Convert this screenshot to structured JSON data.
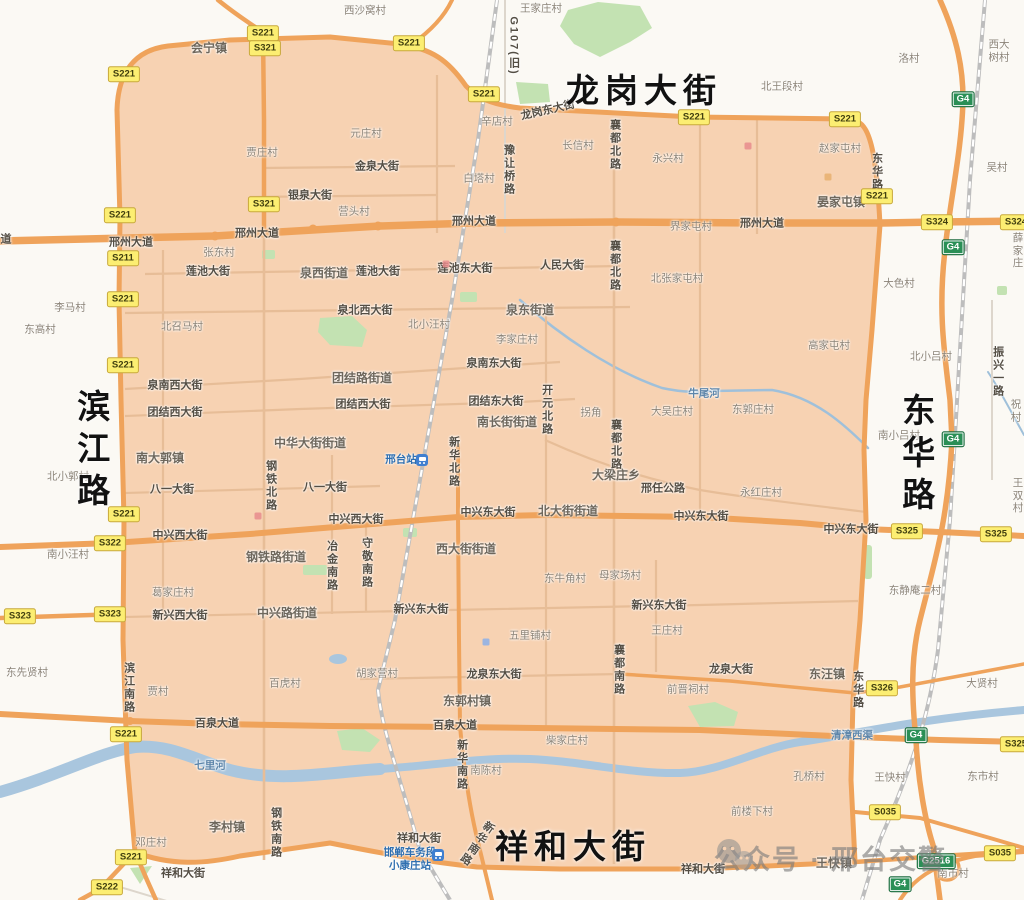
{
  "canvas": {
    "width": 1024,
    "height": 900
  },
  "colors": {
    "zone_fill": "#f7d2b2",
    "road_major": "#efa35b",
    "road_minor_zone": "#e7bd97",
    "road_minor_out": "#ddd6cc",
    "green": "#c3e2b2",
    "water": "#a9c6de",
    "railway": "#bdbdbd",
    "badge_s_bg": "#fcee72",
    "badge_g_bg": "#2a8f56",
    "big_label": "#121212",
    "station_blue": "#2f6fb0"
  },
  "big_labels": [
    {
      "t": "龙岗大街",
      "x": 644,
      "y": 91,
      "c": "bh"
    },
    {
      "t": "滨江路",
      "x": 91,
      "y": 452,
      "c": "bv"
    },
    {
      "t": "东华路",
      "x": 916,
      "y": 456,
      "c": "bv"
    },
    {
      "t": "祥和大街",
      "x": 573,
      "y": 847,
      "c": "bh"
    }
  ],
  "watermark": {
    "text": "公众号 · 邢台交警"
  },
  "labels": [
    {
      "t": "西沙窝村",
      "x": 365,
      "y": 11,
      "c": "v"
    },
    {
      "t": "王家庄村",
      "x": 541,
      "y": 9,
      "c": "v"
    },
    {
      "t": "北王段村",
      "x": 782,
      "y": 87,
      "c": "v"
    },
    {
      "t": "洛村",
      "x": 909,
      "y": 59,
      "c": "v"
    },
    {
      "t": "西大树村",
      "x": 999,
      "y": 51,
      "c": "v"
    },
    {
      "t": "吴村",
      "x": 997,
      "y": 168,
      "c": "v"
    },
    {
      "t": "辛店村",
      "x": 497,
      "y": 122,
      "c": "v"
    },
    {
      "t": "元庄村",
      "x": 366,
      "y": 134,
      "c": "v"
    },
    {
      "t": "贾庄村",
      "x": 262,
      "y": 153,
      "c": "v"
    },
    {
      "t": "白塔村",
      "x": 479,
      "y": 179,
      "c": "v"
    },
    {
      "t": "营头村",
      "x": 354,
      "y": 212,
      "c": "v"
    },
    {
      "t": "张东村",
      "x": 219,
      "y": 253,
      "c": "v"
    },
    {
      "t": "长信村",
      "x": 578,
      "y": 146,
      "c": "v"
    },
    {
      "t": "永兴村",
      "x": 668,
      "y": 159,
      "c": "v"
    },
    {
      "t": "赵家屯村",
      "x": 840,
      "y": 149,
      "c": "v"
    },
    {
      "t": "界家屯村",
      "x": 691,
      "y": 227,
      "c": "v"
    },
    {
      "t": "北张家屯村",
      "x": 677,
      "y": 279,
      "c": "v"
    },
    {
      "t": "大色村",
      "x": 899,
      "y": 284,
      "c": "v"
    },
    {
      "t": "薛家庄",
      "x": 1018,
      "y": 251,
      "c": "v"
    },
    {
      "t": "李马村",
      "x": 70,
      "y": 308,
      "c": "v"
    },
    {
      "t": "东高村",
      "x": 40,
      "y": 330,
      "c": "v"
    },
    {
      "t": "北召马村",
      "x": 182,
      "y": 327,
      "c": "v"
    },
    {
      "t": "北小汪村",
      "x": 429,
      "y": 325,
      "c": "v"
    },
    {
      "t": "李家庄村",
      "x": 517,
      "y": 340,
      "c": "v"
    },
    {
      "t": "高家屯村",
      "x": 829,
      "y": 346,
      "c": "v"
    },
    {
      "t": "北小吕村",
      "x": 931,
      "y": 357,
      "c": "v"
    },
    {
      "t": "南小吕村",
      "x": 899,
      "y": 436,
      "c": "v"
    },
    {
      "t": "祝村",
      "x": 1016,
      "y": 411,
      "c": "v"
    },
    {
      "t": "东郭庄村",
      "x": 753,
      "y": 410,
      "c": "v"
    },
    {
      "t": "大吴庄村",
      "x": 672,
      "y": 412,
      "c": "v"
    },
    {
      "t": "拐角",
      "x": 591,
      "y": 413,
      "c": "v"
    },
    {
      "t": "王双村",
      "x": 1018,
      "y": 496,
      "c": "v"
    },
    {
      "t": "永红庄村",
      "x": 761,
      "y": 493,
      "c": "v"
    },
    {
      "t": "北小郭村",
      "x": 68,
      "y": 477,
      "c": "v"
    },
    {
      "t": "南小汪村",
      "x": 68,
      "y": 555,
      "c": "v"
    },
    {
      "t": "东牛角村",
      "x": 565,
      "y": 579,
      "c": "v"
    },
    {
      "t": "母家场村",
      "x": 620,
      "y": 576,
      "c": "v"
    },
    {
      "t": "葛家庄村",
      "x": 173,
      "y": 593,
      "c": "v"
    },
    {
      "t": "东静庵二村",
      "x": 915,
      "y": 591,
      "c": "v"
    },
    {
      "t": "王庄村",
      "x": 667,
      "y": 631,
      "c": "v"
    },
    {
      "t": "五里铺村",
      "x": 530,
      "y": 636,
      "c": "v"
    },
    {
      "t": "东先贤村",
      "x": 27,
      "y": 673,
      "c": "v"
    },
    {
      "t": "贾村",
      "x": 158,
      "y": 692,
      "c": "v"
    },
    {
      "t": "百虎村",
      "x": 285,
      "y": 684,
      "c": "v"
    },
    {
      "t": "胡家营村",
      "x": 377,
      "y": 674,
      "c": "v"
    },
    {
      "t": "前晋祠村",
      "x": 688,
      "y": 690,
      "c": "v"
    },
    {
      "t": "大贤村",
      "x": 982,
      "y": 684,
      "c": "v"
    },
    {
      "t": "柴家庄村",
      "x": 567,
      "y": 741,
      "c": "v"
    },
    {
      "t": "南陈村",
      "x": 486,
      "y": 771,
      "c": "v"
    },
    {
      "t": "孔桥村",
      "x": 809,
      "y": 777,
      "c": "v"
    },
    {
      "t": "王快村",
      "x": 890,
      "y": 778,
      "c": "v"
    },
    {
      "t": "东市村",
      "x": 983,
      "y": 777,
      "c": "v"
    },
    {
      "t": "前楼下村",
      "x": 752,
      "y": 812,
      "c": "v"
    },
    {
      "t": "邓庄村",
      "x": 151,
      "y": 843,
      "c": "v"
    },
    {
      "t": "南市村",
      "x": 953,
      "y": 874,
      "c": "v"
    },
    {
      "t": "会宁镇",
      "x": 209,
      "y": 48,
      "c": "t"
    },
    {
      "t": "晏家屯镇",
      "x": 841,
      "y": 202,
      "c": "t"
    },
    {
      "t": "泉西街道",
      "x": 324,
      "y": 273,
      "c": "t"
    },
    {
      "t": "泉东街道",
      "x": 530,
      "y": 310,
      "c": "t"
    },
    {
      "t": "团结路街道",
      "x": 362,
      "y": 378,
      "c": "t"
    },
    {
      "t": "中华大街街道",
      "x": 310,
      "y": 443,
      "c": "t"
    },
    {
      "t": "南大郭镇",
      "x": 160,
      "y": 458,
      "c": "t"
    },
    {
      "t": "南长街街道",
      "x": 507,
      "y": 422,
      "c": "t"
    },
    {
      "t": "北大街街道",
      "x": 568,
      "y": 511,
      "c": "t"
    },
    {
      "t": "西大街街道",
      "x": 466,
      "y": 549,
      "c": "t"
    },
    {
      "t": "钢铁路街道",
      "x": 276,
      "y": 557,
      "c": "t"
    },
    {
      "t": "中兴路街道",
      "x": 287,
      "y": 613,
      "c": "t"
    },
    {
      "t": "大梁庄乡",
      "x": 616,
      "y": 475,
      "c": "t"
    },
    {
      "t": "东郭村镇",
      "x": 467,
      "y": 701,
      "c": "t"
    },
    {
      "t": "李村镇",
      "x": 227,
      "y": 827,
      "c": "t"
    },
    {
      "t": "东汪镇",
      "x": 827,
      "y": 674,
      "c": "t"
    },
    {
      "t": "王快镇",
      "x": 834,
      "y": 863,
      "c": "t"
    },
    {
      "t": "龙岗东大街",
      "x": 548,
      "y": 111,
      "c": "s",
      "r": -13
    },
    {
      "t": "金泉大街",
      "x": 377,
      "y": 167,
      "c": "s"
    },
    {
      "t": "银泉大街",
      "x": 310,
      "y": 196,
      "c": "s"
    },
    {
      "t": "邢州大道",
      "x": 131,
      "y": 243,
      "c": "s"
    },
    {
      "t": "邢州大道",
      "x": 257,
      "y": 234,
      "c": "s"
    },
    {
      "t": "邢州大道",
      "x": 474,
      "y": 222,
      "c": "s"
    },
    {
      "t": "邢州大道",
      "x": 762,
      "y": 224,
      "c": "s"
    },
    {
      "t": "莲池大街",
      "x": 208,
      "y": 272,
      "c": "s"
    },
    {
      "t": "莲池大街",
      "x": 378,
      "y": 272,
      "c": "s"
    },
    {
      "t": "莲池东大街",
      "x": 465,
      "y": 269,
      "c": "s"
    },
    {
      "t": "人民大街",
      "x": 562,
      "y": 266,
      "c": "s"
    },
    {
      "t": "泉北西大街",
      "x": 365,
      "y": 311,
      "c": "s"
    },
    {
      "t": "泉南西大街",
      "x": 175,
      "y": 386,
      "c": "s"
    },
    {
      "t": "泉南东大街",
      "x": 494,
      "y": 364,
      "c": "s"
    },
    {
      "t": "团结西大街",
      "x": 175,
      "y": 413,
      "c": "s"
    },
    {
      "t": "团结西大街",
      "x": 363,
      "y": 405,
      "c": "s"
    },
    {
      "t": "团结东大街",
      "x": 496,
      "y": 402,
      "c": "s"
    },
    {
      "t": "八一大街",
      "x": 172,
      "y": 490,
      "c": "s"
    },
    {
      "t": "八一大街",
      "x": 325,
      "y": 488,
      "c": "s"
    },
    {
      "t": "中兴西大街",
      "x": 180,
      "y": 536,
      "c": "s"
    },
    {
      "t": "中兴西大街",
      "x": 356,
      "y": 520,
      "c": "s"
    },
    {
      "t": "中兴东大街",
      "x": 488,
      "y": 513,
      "c": "s"
    },
    {
      "t": "中兴东大街",
      "x": 701,
      "y": 517,
      "c": "s"
    },
    {
      "t": "中兴东大街",
      "x": 851,
      "y": 530,
      "c": "s"
    },
    {
      "t": "新兴西大街",
      "x": 180,
      "y": 616,
      "c": "s"
    },
    {
      "t": "新兴东大街",
      "x": 421,
      "y": 610,
      "c": "s"
    },
    {
      "t": "新兴东大街",
      "x": 659,
      "y": 606,
      "c": "s"
    },
    {
      "t": "龙泉东大街",
      "x": 494,
      "y": 675,
      "c": "s"
    },
    {
      "t": "龙泉大街",
      "x": 731,
      "y": 670,
      "c": "s"
    },
    {
      "t": "百泉大道",
      "x": 217,
      "y": 724,
      "c": "s"
    },
    {
      "t": "百泉大道",
      "x": 455,
      "y": 726,
      "c": "s"
    },
    {
      "t": "祥和大街",
      "x": 183,
      "y": 874,
      "c": "s"
    },
    {
      "t": "祥和大街",
      "x": 419,
      "y": 839,
      "c": "s"
    },
    {
      "t": "祥和大街",
      "x": 703,
      "y": 870,
      "c": "s"
    },
    {
      "t": "邢任公路",
      "x": 663,
      "y": 489,
      "c": "s"
    },
    {
      "t": "道",
      "x": 6,
      "y": 240,
      "c": "s"
    },
    {
      "t": "襄都北路",
      "x": 614,
      "y": 145,
      "c": "sv"
    },
    {
      "t": "襄都北路",
      "x": 614,
      "y": 266,
      "c": "sv"
    },
    {
      "t": "襄都北路",
      "x": 615,
      "y": 445,
      "c": "sv"
    },
    {
      "t": "襄都南路",
      "x": 618,
      "y": 670,
      "c": "sv"
    },
    {
      "t": "豫让桥路",
      "x": 508,
      "y": 170,
      "c": "sv"
    },
    {
      "t": "东华路",
      "x": 876,
      "y": 172,
      "c": "sv"
    },
    {
      "t": "东华路",
      "x": 857,
      "y": 690,
      "c": "sv"
    },
    {
      "t": "开元北路",
      "x": 546,
      "y": 410,
      "c": "sv"
    },
    {
      "t": "新华北路",
      "x": 453,
      "y": 462,
      "c": "sv"
    },
    {
      "t": "新华南路",
      "x": 461,
      "y": 765,
      "c": "sv"
    },
    {
      "t": "新华南路",
      "x": 476,
      "y": 843,
      "c": "sv",
      "r": 35
    },
    {
      "t": "冶金南路",
      "x": 331,
      "y": 566,
      "c": "sv"
    },
    {
      "t": "守敬南路",
      "x": 366,
      "y": 563,
      "c": "sv"
    },
    {
      "t": "钢铁北路",
      "x": 270,
      "y": 486,
      "c": "sv"
    },
    {
      "t": "钢铁南路",
      "x": 275,
      "y": 833,
      "c": "sv"
    },
    {
      "t": "滨江南路",
      "x": 128,
      "y": 688,
      "c": "sv"
    },
    {
      "t": "振兴一路",
      "x": 997,
      "y": 372,
      "c": "sv"
    },
    {
      "t": "G107(旧)",
      "x": 513,
      "y": 46,
      "c": "sv"
    },
    {
      "t": "七里河",
      "x": 210,
      "y": 766,
      "c": "r"
    },
    {
      "t": "牛尾河",
      "x": 704,
      "y": 394,
      "c": "r"
    },
    {
      "t": "清漳西渠",
      "x": 852,
      "y": 736,
      "c": "r"
    },
    {
      "t": "邢台站",
      "x": 401,
      "y": 460,
      "c": "st"
    },
    {
      "t": "邯郸车务段\n小康庄站",
      "x": 410,
      "y": 859,
      "c": "st"
    }
  ],
  "badges": [
    {
      "code": "S221",
      "x": 263,
      "y": 33,
      "k": "s"
    },
    {
      "code": "S321",
      "x": 265,
      "y": 48,
      "k": "s"
    },
    {
      "code": "S221",
      "x": 124,
      "y": 74,
      "k": "s"
    },
    {
      "code": "S221",
      "x": 409,
      "y": 43,
      "k": "s"
    },
    {
      "code": "S221",
      "x": 484,
      "y": 94,
      "k": "s"
    },
    {
      "code": "S221",
      "x": 694,
      "y": 117,
      "k": "s"
    },
    {
      "code": "S221",
      "x": 845,
      "y": 119,
      "k": "s"
    },
    {
      "code": "S221",
      "x": 877,
      "y": 196,
      "k": "s"
    },
    {
      "code": "S221",
      "x": 120,
      "y": 215,
      "k": "s"
    },
    {
      "code": "S321",
      "x": 264,
      "y": 204,
      "k": "s"
    },
    {
      "code": "S211",
      "x": 123,
      "y": 258,
      "k": "s"
    },
    {
      "code": "S221",
      "x": 123,
      "y": 299,
      "k": "s"
    },
    {
      "code": "S221",
      "x": 123,
      "y": 365,
      "k": "s"
    },
    {
      "code": "S221",
      "x": 124,
      "y": 514,
      "k": "s"
    },
    {
      "code": "S322",
      "x": 110,
      "y": 543,
      "k": "s"
    },
    {
      "code": "S323",
      "x": 20,
      "y": 616,
      "k": "s"
    },
    {
      "code": "S323",
      "x": 110,
      "y": 614,
      "k": "s"
    },
    {
      "code": "S221",
      "x": 126,
      "y": 734,
      "k": "s"
    },
    {
      "code": "S221",
      "x": 131,
      "y": 857,
      "k": "s"
    },
    {
      "code": "S222",
      "x": 107,
      "y": 887,
      "k": "s"
    },
    {
      "code": "S324",
      "x": 937,
      "y": 222,
      "k": "s"
    },
    {
      "code": "S324",
      "x": 1016,
      "y": 222,
      "k": "s"
    },
    {
      "code": "S325",
      "x": 907,
      "y": 531,
      "k": "s"
    },
    {
      "code": "S325",
      "x": 996,
      "y": 534,
      "k": "s"
    },
    {
      "code": "S325",
      "x": 1016,
      "y": 744,
      "k": "s"
    },
    {
      "code": "S326",
      "x": 882,
      "y": 688,
      "k": "s"
    },
    {
      "code": "S035",
      "x": 885,
      "y": 812,
      "k": "s"
    },
    {
      "code": "S035",
      "x": 1000,
      "y": 853,
      "k": "s"
    },
    {
      "code": "G4",
      "x": 963,
      "y": 99,
      "k": "g"
    },
    {
      "code": "G4",
      "x": 953,
      "y": 247,
      "k": "g"
    },
    {
      "code": "G4",
      "x": 953,
      "y": 439,
      "k": "g"
    },
    {
      "code": "G4",
      "x": 916,
      "y": 735,
      "k": "g"
    },
    {
      "code": "G4",
      "x": 900,
      "y": 884,
      "k": "g"
    },
    {
      "code": "G2516",
      "x": 936,
      "y": 861,
      "k": "g"
    }
  ],
  "station_icons": [
    {
      "x": 422,
      "y": 460
    },
    {
      "x": 438,
      "y": 855
    }
  ],
  "poi_markers": [
    {
      "x": 446,
      "y": 264,
      "color": "#e88c8c"
    },
    {
      "x": 748,
      "y": 146,
      "color": "#e88c8c"
    },
    {
      "x": 258,
      "y": 516,
      "color": "#e88c8c"
    },
    {
      "x": 486,
      "y": 642,
      "color": "#8cb0e8"
    },
    {
      "x": 828,
      "y": 177,
      "color": "#e8b06e"
    }
  ]
}
